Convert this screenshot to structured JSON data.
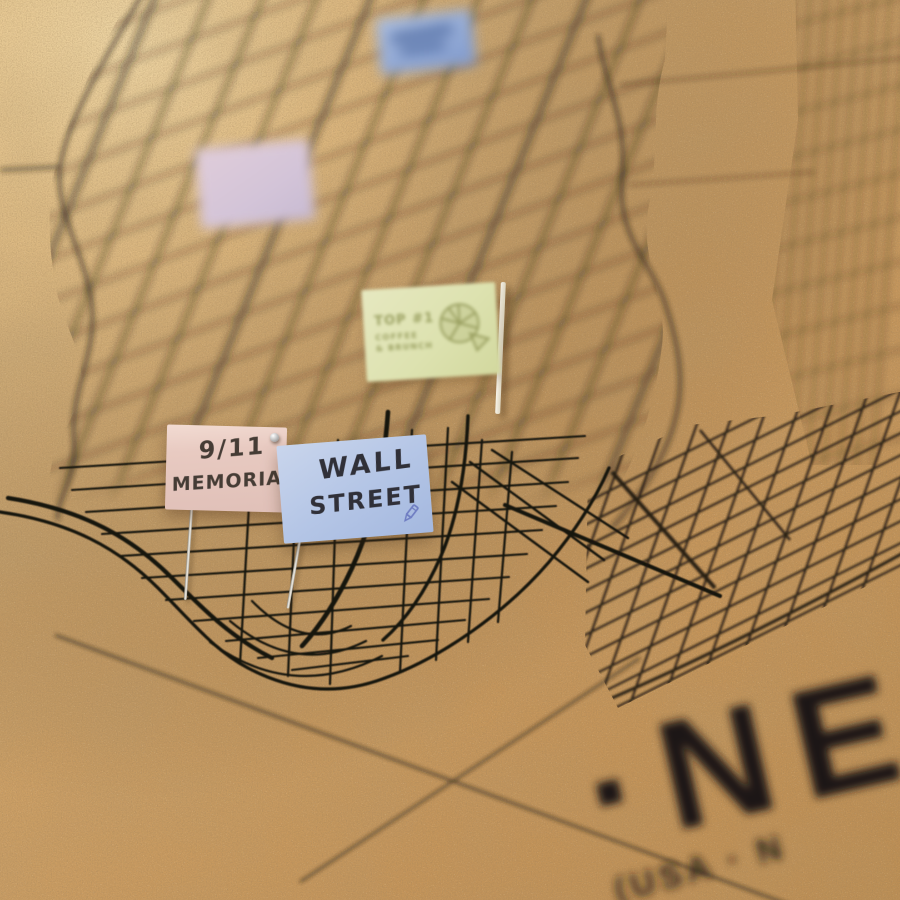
{
  "map_title": {
    "visible_text": "·NE",
    "visible_subtitle": "(USA · N",
    "color": "#201a12"
  },
  "board": {
    "cork_color": "#c89a60",
    "street_line_color": "#231c14",
    "needle_color": "#cfcbc2",
    "white_pin_color": "#f3eede",
    "pin_head_color": "#d6d6d6"
  },
  "flags": {
    "blurred_blue_top": {
      "paper_color": "#9db3d9"
    },
    "blurred_pink": {
      "paper_color": "#d9c6d6"
    },
    "green_preprinted": {
      "line1": "TOP #1",
      "line2": "COFFEE",
      "line3": "& BRUNCH",
      "icon": "pie-slices-icon",
      "paper_color": "#dfe3b3",
      "ink_color": "#9aa061"
    },
    "memorial_911": {
      "line1": "9/11",
      "line2": "MEMORIAL",
      "paper_color": "#ecd2c9",
      "ink_color": "#453c35"
    },
    "wall_street": {
      "line1": "WALL",
      "line2": "STREET",
      "icon": "pencil-icon",
      "paper_color": "#bac9e8",
      "ink_color": "#303038"
    }
  }
}
